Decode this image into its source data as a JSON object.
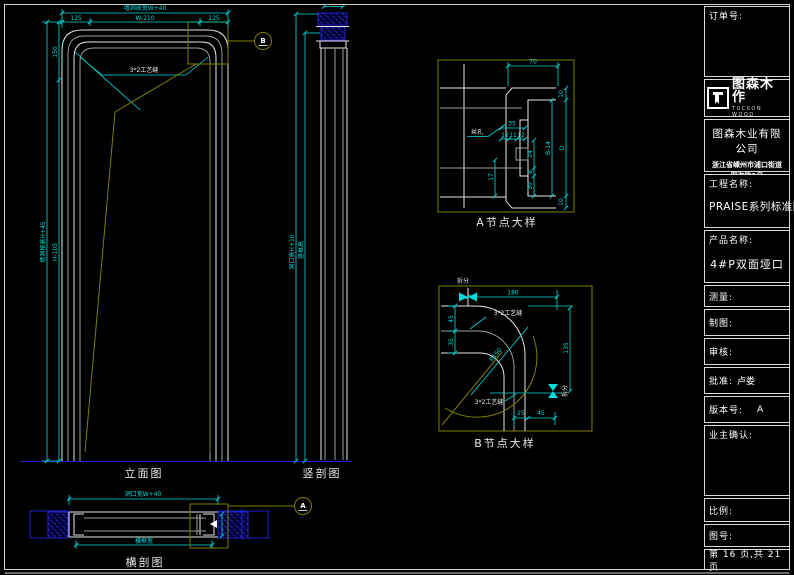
{
  "colors": {
    "background": "#000000",
    "dimension_cyan": "#00dbdb",
    "line_white": "#e6e6e6",
    "line_gray": "#9e9e9e",
    "detail_olive": "#7e7e00",
    "wall_blue": "#2121cc",
    "text_white": "#ffffff"
  },
  "title_block": {
    "order_label": "订单号:",
    "logo": {
      "brand": "图森木作",
      "brand_sub": "TUCSON WOOD"
    },
    "company_name": "图森木业有限公司",
    "company_address_line1": "浙江省嵊州市浦口街道",
    "company_address_line2": "四海路1号",
    "project_label": "工程名称:",
    "project_value": "PRAISE系列标准图",
    "product_label": "产品名称:",
    "product_value": "4#P双面垭口",
    "measure_label": "测量:",
    "draft_label": "制图:",
    "review_label": "审核:",
    "approve_label": "批准:",
    "approve_value": "卢娄",
    "version_label": "版本号:",
    "version_value": "A",
    "owner_confirm_label": "业主确认:",
    "scale_label": "比例:",
    "drawing_no_label": "图号:",
    "page_text": "第 16 页,共 21 页"
  },
  "views": {
    "elevation": {
      "label": "立面图",
      "dim_wall_width": "墙洞按宽W+40",
      "dim_left_seg": "125",
      "dim_mid_seg": "W-210",
      "dim_right_seg": "125",
      "dim_wall_height": "墙洞按高H+45",
      "dim_top_seg": "150",
      "dim_main_seg": "H-105",
      "seam_note": "3*2工艺缝",
      "callout": "B"
    },
    "vertical_section": {
      "label": "竖剖图",
      "dim_opening_height": "洞口高H+10",
      "dim_frame_height": "竖框高"
    },
    "detail_a": {
      "label": "A节点大样",
      "dim_70": "70",
      "dim_d": "D",
      "dim_10_top": "10",
      "dim_10_bottom": "10",
      "dim_b14": "B-14",
      "dim_35": "35",
      "dim_12a": "12",
      "dim_11": "11",
      "dim_12b": "12",
      "dim_17": "17",
      "dim_24": "24",
      "dim_8": "8",
      "dim_30": "30",
      "leader_note": "丝孔"
    },
    "detail_b": {
      "label": "B节点大样",
      "dim_180": "180",
      "dim_45_left": "45",
      "dim_35_left": "35",
      "dim_radius": "R150",
      "dim_135": "135",
      "dim_25": "25",
      "dim_45_bottom": "45",
      "seam_note_top": "3*2工艺缝",
      "seam_note_bottom": "3*2工艺缝",
      "split_label_top": "拆分",
      "split_label_side": "拆分"
    },
    "cross_section": {
      "label": "横剖图",
      "dim_opening_width": "洞口宽W+40",
      "dim_frame_width": "横框宽",
      "callout": "A"
    }
  }
}
